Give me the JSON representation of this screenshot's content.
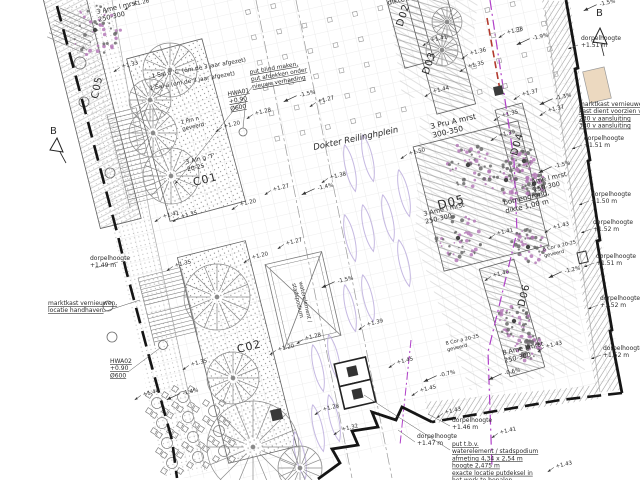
{
  "drawing": {
    "place_label": "Dokter Reilinghplein",
    "section_marker": "B"
  },
  "area_labels": [
    {
      "text": "C05",
      "x": 100,
      "y": 88,
      "rot": -78,
      "size": 10
    },
    {
      "text": "C01",
      "x": 206,
      "y": 183,
      "rot": -14,
      "size": 11
    },
    {
      "text": "C02",
      "x": 250,
      "y": 350,
      "rot": -14,
      "size": 11
    },
    {
      "text": "D02",
      "x": 406,
      "y": 16,
      "rot": -72,
      "size": 10
    },
    {
      "text": "D03",
      "x": 432,
      "y": 64,
      "rot": -72,
      "size": 10
    },
    {
      "text": "D04",
      "x": 520,
      "y": 145,
      "rot": -74,
      "size": 10
    },
    {
      "text": "D05",
      "x": 452,
      "y": 206,
      "rot": -14,
      "size": 12
    },
    {
      "text": "D06",
      "x": 527,
      "y": 296,
      "rot": -76,
      "size": 10
    }
  ],
  "species_labels": [
    {
      "lines": [
        "3 Ame l mrst",
        "250-300"
      ],
      "x": 97,
      "y": 14,
      "rot": -13,
      "size": 6.5
    },
    {
      "lines": [
        "1 Sal a 'C' (om de 3 jaar afgezet)"
      ],
      "x": 152,
      "y": 78,
      "rot": -10,
      "size": 5.8
    },
    {
      "lines": [
        "1 Sal a (om de 3 jaar afgezet)"
      ],
      "x": 150,
      "y": 90,
      "rot": -10,
      "size": 5.8
    },
    {
      "lines": [
        "HWA01",
        "+0.90",
        "Ø600"
      ],
      "x": 228,
      "y": 96,
      "rot": -10,
      "size": 6,
      "underline": true
    },
    {
      "lines": [
        "1 Pin n",
        "geveerd"
      ],
      "x": 181,
      "y": 124,
      "rot": -13,
      "size": 5.5
    },
    {
      "lines": [
        "3 Aln g 'T'",
        "20-25"
      ],
      "x": 186,
      "y": 164,
      "rot": -13,
      "size": 6
    },
    {
      "lines": [
        "3 Pru A mrst",
        "300-350"
      ],
      "x": 431,
      "y": 129,
      "rot": -13,
      "size": 7.5
    },
    {
      "lines": [
        "dikte 1,00 m"
      ],
      "x": 388,
      "y": 5,
      "rot": -13,
      "size": 7
    },
    {
      "lines": [
        "bomengrond,",
        "dikte 1,00 m"
      ],
      "x": 504,
      "y": 205,
      "rot": -13,
      "size": 7
    },
    {
      "lines": [
        "Ame l mrst",
        "250-300"
      ],
      "x": 532,
      "y": 184,
      "rot": -13,
      "size": 6.5
    },
    {
      "lines": [
        "8 Ame l mrst",
        "250-300"
      ],
      "x": 503,
      "y": 355,
      "rot": -13,
      "size": 6.5
    },
    {
      "lines": [
        "3 Ame l mrst",
        "250-300"
      ],
      "x": 424,
      "y": 216,
      "rot": -13,
      "size": 6.5
    },
    {
      "lines": [
        "8 Cor a 20-25",
        "geveerd"
      ],
      "x": 543,
      "y": 251,
      "rot": -13,
      "size": 5
    },
    {
      "lines": [
        "8 Cor a 20-25",
        "geveerd"
      ],
      "x": 446,
      "y": 345,
      "rot": -13,
      "size": 5
    },
    {
      "lines": [
        "waterelement /",
        "stadspodium"
      ],
      "x": 299,
      "y": 282,
      "rot": 77,
      "size": 5.5
    },
    {
      "lines": [
        "Dokter Reilinghplein"
      ],
      "x": 314,
      "y": 150,
      "rot": -12,
      "size": 8.5,
      "italic": true
    },
    {
      "lines": [
        "put blind maken,",
        "put afdekken onder",
        "nieuwe verharding"
      ],
      "x": 250,
      "y": 74,
      "rot": -10,
      "size": 5.8,
      "underline": true
    }
  ],
  "notes": [
    {
      "lines": [
        "dorpelhoogte",
        "+1.51 m"
      ],
      "x": 581,
      "y": 40
    },
    {
      "lines": [
        "marktkast vernieuwen,",
        "kast dient voorzien van:",
        "230 v aansluiting",
        "380 v aansluiting"
      ],
      "x": 579,
      "y": 106,
      "underline": true
    },
    {
      "lines": [
        "dorpelhoogte",
        "+1.51 m"
      ],
      "x": 584,
      "y": 140
    },
    {
      "lines": [
        "dorpelhoogte",
        "+1.50 m"
      ],
      "x": 591,
      "y": 196
    },
    {
      "lines": [
        "dorpelhoogte",
        "+1.52 m"
      ],
      "x": 593,
      "y": 224
    },
    {
      "lines": [
        "dorpelhoogte",
        "+1.51 m"
      ],
      "x": 596,
      "y": 258
    },
    {
      "lines": [
        "dorpelhoogte",
        "+1.52 m"
      ],
      "x": 600,
      "y": 300
    },
    {
      "lines": [
        "dorpelhoogte",
        "+1.52 m"
      ],
      "x": 603,
      "y": 350
    },
    {
      "lines": [
        "dorpelhoogte",
        "+1.46 m"
      ],
      "x": 452,
      "y": 422
    },
    {
      "lines": [
        "dorpelhoogte",
        "+1.47 m"
      ],
      "x": 417,
      "y": 438
    },
    {
      "lines": [
        "put t.b.v.",
        "waterelement / stadspodium",
        "afmeting 4,34 x 2,54 m",
        "hoogte 2,475 m",
        "exacte locatie putdeksel in",
        "het werk te bepalen"
      ],
      "x": 452,
      "y": 446,
      "underline": true
    },
    {
      "lines": [
        "dorpelhoogte",
        "+1.49 m"
      ],
      "x": 90,
      "y": 260
    },
    {
      "lines": [
        "marktkast vernieuwen,",
        "locatie handhaven"
      ],
      "x": 48,
      "y": 305,
      "underline": true
    },
    {
      "lines": [
        "HWA02",
        "+0.90",
        "Ø600"
      ],
      "x": 110,
      "y": 363,
      "underline": true
    }
  ],
  "spot_heights": [
    {
      "v": "+1.26",
      "x": 133,
      "y": 6
    },
    {
      "v": "+1.33",
      "x": 122,
      "y": 68
    },
    {
      "v": "+1.28",
      "x": 255,
      "y": 115
    },
    {
      "v": "+1.20",
      "x": 224,
      "y": 128
    },
    {
      "v": "+1.41",
      "x": 431,
      "y": 42
    },
    {
      "v": "+1.36",
      "x": 470,
      "y": 55
    },
    {
      "v": "+1.35",
      "x": 468,
      "y": 68
    },
    {
      "v": "+1.38",
      "x": 507,
      "y": 34
    },
    {
      "v": "+1.44",
      "x": 433,
      "y": 93
    },
    {
      "v": "+1.37",
      "x": 522,
      "y": 96
    },
    {
      "v": "+1.37",
      "x": 548,
      "y": 112
    },
    {
      "v": "+1.35",
      "x": 502,
      "y": 117
    },
    {
      "v": "+1.39",
      "x": 499,
      "y": 137
    },
    {
      "v": "+1.50",
      "x": 409,
      "y": 155
    },
    {
      "v": "+1.38",
      "x": 330,
      "y": 179
    },
    {
      "v": "+1.27",
      "x": 273,
      "y": 191
    },
    {
      "v": "+1.20",
      "x": 240,
      "y": 206
    },
    {
      "v": "+1.41",
      "x": 163,
      "y": 218
    },
    {
      "v": "+1.35",
      "x": 181,
      "y": 218
    },
    {
      "v": "+1.27",
      "x": 286,
      "y": 245
    },
    {
      "v": "+1.20",
      "x": 252,
      "y": 259
    },
    {
      "v": "+1.35",
      "x": 175,
      "y": 267
    },
    {
      "v": "+1.28",
      "x": 305,
      "y": 340
    },
    {
      "v": "+1.39",
      "x": 367,
      "y": 326
    },
    {
      "v": "+1.20",
      "x": 278,
      "y": 351
    },
    {
      "v": "+1.35",
      "x": 191,
      "y": 366
    },
    {
      "v": "+1.28",
      "x": 323,
      "y": 411
    },
    {
      "v": "+1.32",
      "x": 342,
      "y": 431
    },
    {
      "v": "+1.45",
      "x": 397,
      "y": 364
    },
    {
      "v": "+1.45",
      "x": 420,
      "y": 392
    },
    {
      "v": "+1.43",
      "x": 445,
      "y": 414
    },
    {
      "v": "+1.40",
      "x": 493,
      "y": 277
    },
    {
      "v": "+1.43",
      "x": 546,
      "y": 348
    },
    {
      "v": "+1.41",
      "x": 497,
      "y": 235
    },
    {
      "v": "+1.43",
      "x": 553,
      "y": 229
    },
    {
      "v": "+1.44",
      "x": 143,
      "y": 396
    },
    {
      "v": "+1.41",
      "x": 500,
      "y": 434
    },
    {
      "v": "+1.43",
      "x": 556,
      "y": 468
    },
    {
      "v": "+1.27",
      "x": 318,
      "y": 103
    }
  ],
  "slopes": [
    {
      "v": "-1.5%",
      "x": 600,
      "y": 6
    },
    {
      "v": "-1.9%",
      "x": 533,
      "y": 40
    },
    {
      "v": "-1.3%",
      "x": 556,
      "y": 100
    },
    {
      "v": "-1.4%",
      "x": 318,
      "y": 190
    },
    {
      "v": "-1.5%",
      "x": 338,
      "y": 283
    },
    {
      "v": "-0.7%",
      "x": 440,
      "y": 377
    },
    {
      "v": "-0.6%",
      "x": 505,
      "y": 375
    },
    {
      "v": "-1.2%",
      "x": 565,
      "y": 273
    },
    {
      "v": "-1.5%",
      "x": 555,
      "y": 168
    },
    {
      "v": "-1.4%",
      "x": 183,
      "y": 395
    },
    {
      "v": "-1.5%",
      "x": 300,
      "y": 97
    }
  ]
}
